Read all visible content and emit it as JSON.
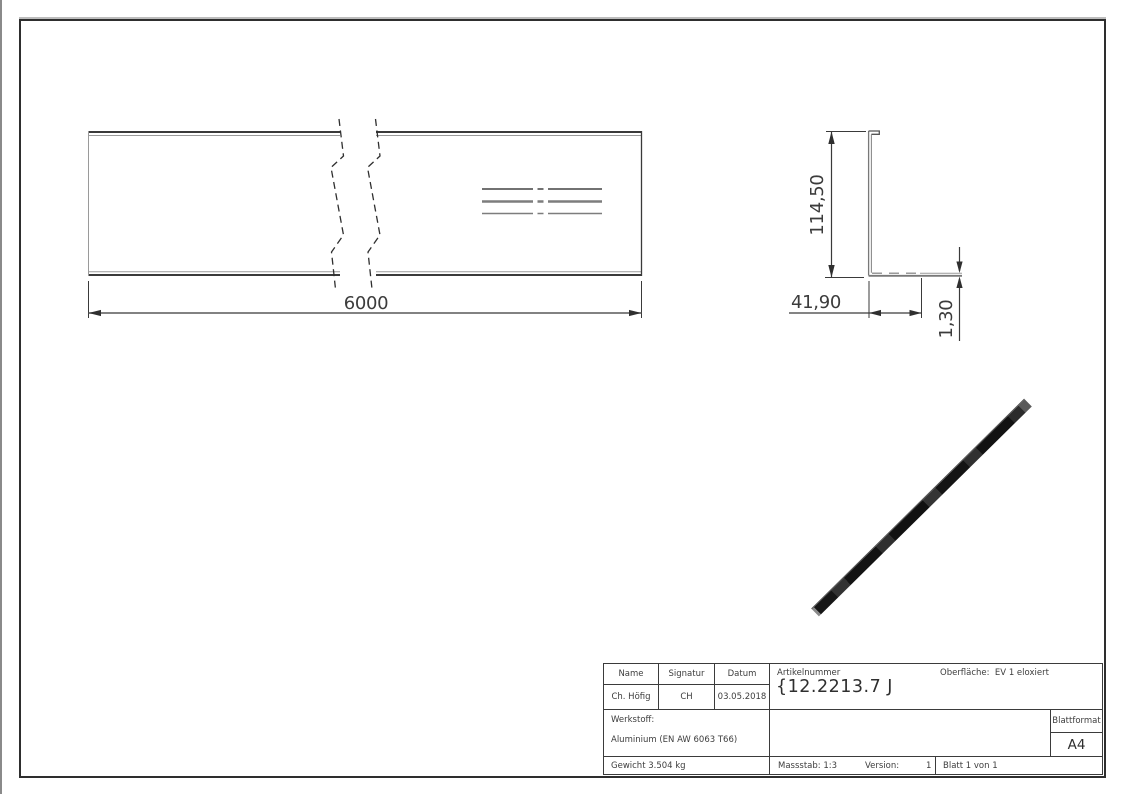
{
  "page": {
    "background": "#ffffff",
    "frame_color": "#2e2e2e",
    "line_black": "#3a3a3a",
    "line_gray": "#7d7d7d",
    "bar_color": "#141414"
  },
  "front_view": {
    "length_dim": "6000"
  },
  "section_view": {
    "height_dim": "114,50",
    "width_dim": "41,90",
    "thickness_dim": "1,30"
  },
  "title_block": {
    "name_label": "Name",
    "signatur_label": "Signatur",
    "datum_label": "Datum",
    "name_value": "Ch. Höfig",
    "signatur_value": "CH",
    "datum_value": "03.05.2018",
    "artikelnummer_label": "Artikelnummer",
    "artikelnummer_value": "{12.2213.7 J",
    "oberflaeche": "Oberfläche:  EV 1 eloxiert",
    "werkstoff_label": "Werkstoff:",
    "werkstoff_value": "Aluminium (EN AW 6063 T66)",
    "gewicht": "Gewicht 3.504 kg",
    "massstab": "Massstab: 1:3",
    "version_label": "Version:",
    "version_value": "1",
    "blatt": "Blatt 1 von 1",
    "blattformat_label": "Blattformat",
    "blattformat_value": "A4"
  }
}
